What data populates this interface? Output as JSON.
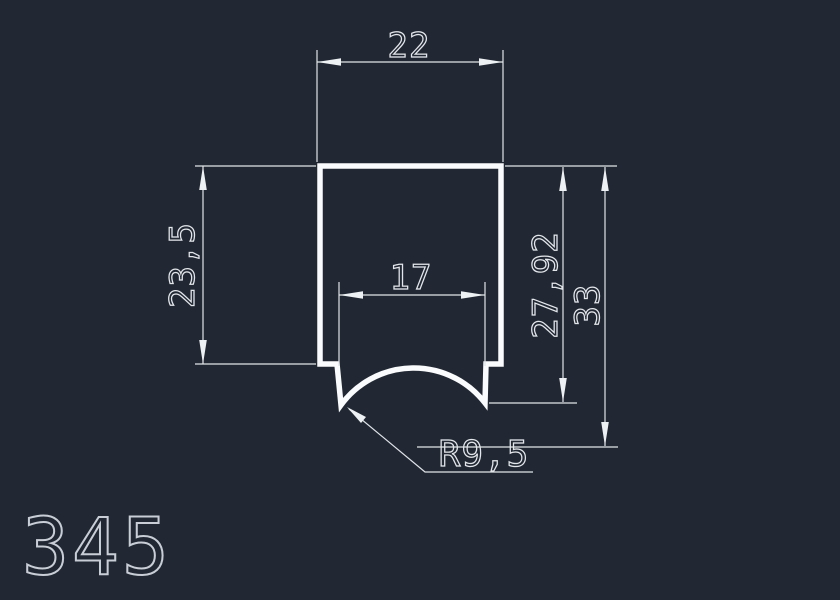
{
  "title": {
    "drawing_number": "345"
  },
  "dimensions": {
    "top_width": {
      "label": "22",
      "value_mm": 22
    },
    "left_height": {
      "label": "23,5",
      "value_mm": 23.5
    },
    "slot_width": {
      "label": "17",
      "value_mm": 17
    },
    "inner_height": {
      "label": "27,92",
      "value_mm": 27.92
    },
    "total_height": {
      "label": "33",
      "value_mm": 33
    },
    "radius": {
      "label": "R9,5",
      "value_mm": 9.5
    }
  },
  "colors": {
    "background": "#212833",
    "profile_line": "#fafbfc",
    "dimension_line": "#e0e4e8",
    "dimension_text": "#e3e6ea",
    "title_text": "#c9ced6"
  }
}
